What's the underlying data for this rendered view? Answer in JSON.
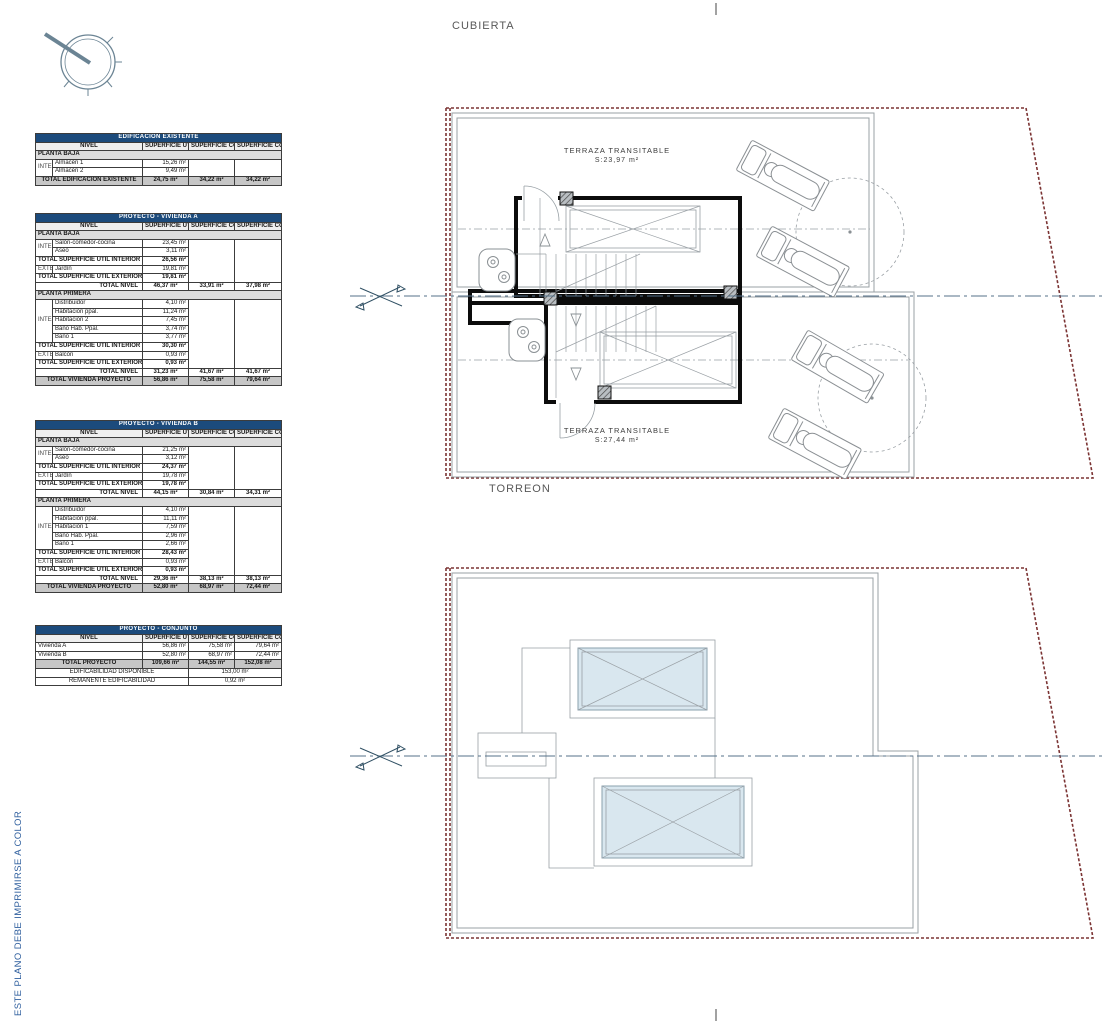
{
  "annotations": {
    "print_note": "ESTE PLANO DEBE IMPRIMIRSE A COLOR",
    "plan_top_title": "CUBIERTA",
    "plan_top_sublabel": "TORREON",
    "terraza_a_line1": "TERRAZA TRANSITABLE",
    "terraza_a_line2": "S:23,97 m²",
    "terraza_b_line1": "TERRAZA TRANSITABLE",
    "terraza_b_line2": "S:27,44 m²"
  },
  "colors": {
    "table_header_blue": "#1c4b7c",
    "plot_boundary_red": "#7b3333",
    "plan_gray": "#9aa0a4",
    "centerline_blue": "#54718a",
    "skylight_blue": "#d9e7ef",
    "note_blue": "#2f5f9e"
  },
  "tables": [
    {
      "name": "edificacion-existente",
      "title": "EDIFICACION EXISTENTE",
      "col_nivel": "NIVEL",
      "cols": [
        "SUPERFICIE\nUTIL",
        "SUPERFICIE\nCONSTRUIDA",
        "SUPERFICIE\nCOMPUTABLE"
      ],
      "rows": [
        {
          "t": "section",
          "label": "PLANTA BAJA"
        },
        {
          "t": "item",
          "g": "INTERIOR",
          "gspan": 2,
          "espan": 2,
          "label": "Almacén 1",
          "u": "15,26 m²"
        },
        {
          "t": "item",
          "label": "Almacén 2",
          "u": "9,49 m²"
        },
        {
          "t": "grand",
          "label": "TOTAL EDIFICACION EXISTENTE",
          "v": [
            "24,75 m²",
            "34,22 m²",
            "34,22 m²"
          ]
        }
      ]
    },
    {
      "name": "proyecto-vivienda-a",
      "title": "PROYECTO - VIVIENDA A",
      "col_nivel": "NIVEL",
      "cols": [
        "SUPERFICIE\nUTIL",
        "SUPERFICIE\nCONSTRUIDA",
        "SUPERFICIE\nCOMPUTABLE"
      ],
      "rows": [
        {
          "t": "section",
          "label": "PLANTA BAJA"
        },
        {
          "t": "item",
          "g": "INTERIOR",
          "gspan": 2,
          "espan": 5,
          "label": "Salón-comedor-cocina",
          "u": "23,45 m²"
        },
        {
          "t": "item",
          "label": "Aseo",
          "u": "3,11 m²"
        },
        {
          "t": "subtotal",
          "label": "TOTAL SUPERFICIE UTIL INTERIOR",
          "u": "26,56 m²"
        },
        {
          "t": "item",
          "g": "EXTERIOR",
          "gspan": 1,
          "label": "Jardín",
          "u": "19,81 m²"
        },
        {
          "t": "subtotal",
          "label": "TOTAL SUPERFICIE UTIL EXTERIOR",
          "u": "19,81 m²"
        },
        {
          "t": "total",
          "label": "TOTAL NIVEL",
          "v": [
            "46,37 m²",
            "33,91 m²",
            "37,98 m²"
          ]
        },
        {
          "t": "section",
          "label": "PLANTA PRIMERA"
        },
        {
          "t": "item",
          "g": "INTERIOR",
          "gspan": 5,
          "espan": 8,
          "label": "Distribuidor",
          "u": "4,10 m²"
        },
        {
          "t": "item",
          "label": "Habitación ppal.",
          "u": "11,24 m²"
        },
        {
          "t": "item",
          "label": "Habitación 2",
          "u": "7,45 m²"
        },
        {
          "t": "item",
          "label": "Baño Hab. Ppal.",
          "u": "3,74 m²"
        },
        {
          "t": "item",
          "label": "Baño 1",
          "u": "3,77 m²"
        },
        {
          "t": "subtotal",
          "label": "TOTAL SUPERFICIE UTIL INTERIOR",
          "u": "30,30 m²"
        },
        {
          "t": "item",
          "g": "EXTERIOR",
          "gspan": 1,
          "label": "Balcón",
          "u": "0,93 m²"
        },
        {
          "t": "subtotal",
          "label": "TOTAL SUPERFICIE UTIL EXTERIOR",
          "u": "0,93 m²"
        },
        {
          "t": "total",
          "label": "TOTAL NIVEL",
          "v": [
            "31,23 m²",
            "41,67 m²",
            "41,67 m²"
          ]
        },
        {
          "t": "grand",
          "label": "TOTAL VIVIENDA PROYECTO",
          "v": [
            "56,86 m²",
            "75,58 m²",
            "79,64 m²"
          ]
        }
      ]
    },
    {
      "name": "proyecto-vivienda-b",
      "title": "PROYECTO - VIVIENDA B",
      "col_nivel": "NIVEL",
      "cols": [
        "SUPERFICIE\nUTIL",
        "SUPERFICIE\nCONSTRUIDA",
        "SUPERFICIE\nCOMPUTABLE"
      ],
      "rows": [
        {
          "t": "section",
          "label": "PLANTA BAJA"
        },
        {
          "t": "item",
          "g": "INTERIOR",
          "gspan": 2,
          "espan": 5,
          "label": "Salón-comedor-cocina",
          "u": "21,25 m²"
        },
        {
          "t": "item",
          "label": "Aseo",
          "u": "3,12 m²"
        },
        {
          "t": "subtotal",
          "label": "TOTAL SUPERFICIE UTIL INTERIOR",
          "u": "24,37 m²"
        },
        {
          "t": "item",
          "g": "EXTERIOR",
          "gspan": 1,
          "label": "Jardín",
          "u": "19,78 m²"
        },
        {
          "t": "subtotal",
          "label": "TOTAL SUPERFICIE UTIL EXTERIOR",
          "u": "19,78 m²"
        },
        {
          "t": "total",
          "label": "TOTAL NIVEL",
          "v": [
            "44,15 m²",
            "30,84 m²",
            "34,31 m²"
          ]
        },
        {
          "t": "section",
          "label": "PLANTA PRIMERA"
        },
        {
          "t": "item",
          "g": "INTERIOR",
          "gspan": 5,
          "espan": 8,
          "label": "Distribuidor",
          "u": "4,10 m²"
        },
        {
          "t": "item",
          "label": "Habitación ppal.",
          "u": "11,11 m²"
        },
        {
          "t": "item",
          "label": "Habitación 1",
          "u": "7,59 m²"
        },
        {
          "t": "item",
          "label": "Baño Hab. Ppal.",
          "u": "2,96 m²"
        },
        {
          "t": "item",
          "label": "Baño 1",
          "u": "2,66 m²"
        },
        {
          "t": "subtotal",
          "label": "TOTAL SUPERFICIE UTIL INTERIOR",
          "u": "28,43 m²"
        },
        {
          "t": "item",
          "g": "EXTERIOR",
          "gspan": 1,
          "label": "Balcón",
          "u": "0,93 m²"
        },
        {
          "t": "subtotal",
          "label": "TOTAL SUPERFICIE UTIL EXTERIOR",
          "u": "0,93 m²"
        },
        {
          "t": "total",
          "label": "TOTAL NIVEL",
          "v": [
            "29,36 m²",
            "38,13 m²",
            "38,13 m²"
          ]
        },
        {
          "t": "grand",
          "label": "TOTAL VIVIENDA PROYECTO",
          "v": [
            "52,80 m²",
            "68,97 m²",
            "72,44 m²"
          ]
        }
      ]
    },
    {
      "name": "proyecto-conjunto",
      "title": "PROYECTO - CONJUNTO",
      "col_nivel": "NIVEL",
      "cols": [
        "SUPERFICIE\nUTIL",
        "SUPERFICIE\nCONSTRUIDA",
        "SUPERFICIE\nCOMPUTABLE"
      ],
      "rows": [
        {
          "t": "plain",
          "label": "Vivienda A",
          "v": [
            "56,86 m²",
            "75,58 m²",
            "79,64 m²"
          ]
        },
        {
          "t": "plain",
          "label": "Vivienda B",
          "v": [
            "52,80 m²",
            "68,97 m²",
            "72,44 m²"
          ]
        },
        {
          "t": "grand",
          "label": "TOTAL PROYECTO",
          "v": [
            "109,66 m²",
            "144,55 m²",
            "152,08 m²"
          ]
        },
        {
          "t": "span",
          "label": "EDIFICABILIDAD DISPONIBLE",
          "value": "153,00 m²"
        },
        {
          "t": "span",
          "label": "REMANENTE EDIFICABILIDAD",
          "value": "0,92 m²"
        }
      ]
    }
  ]
}
